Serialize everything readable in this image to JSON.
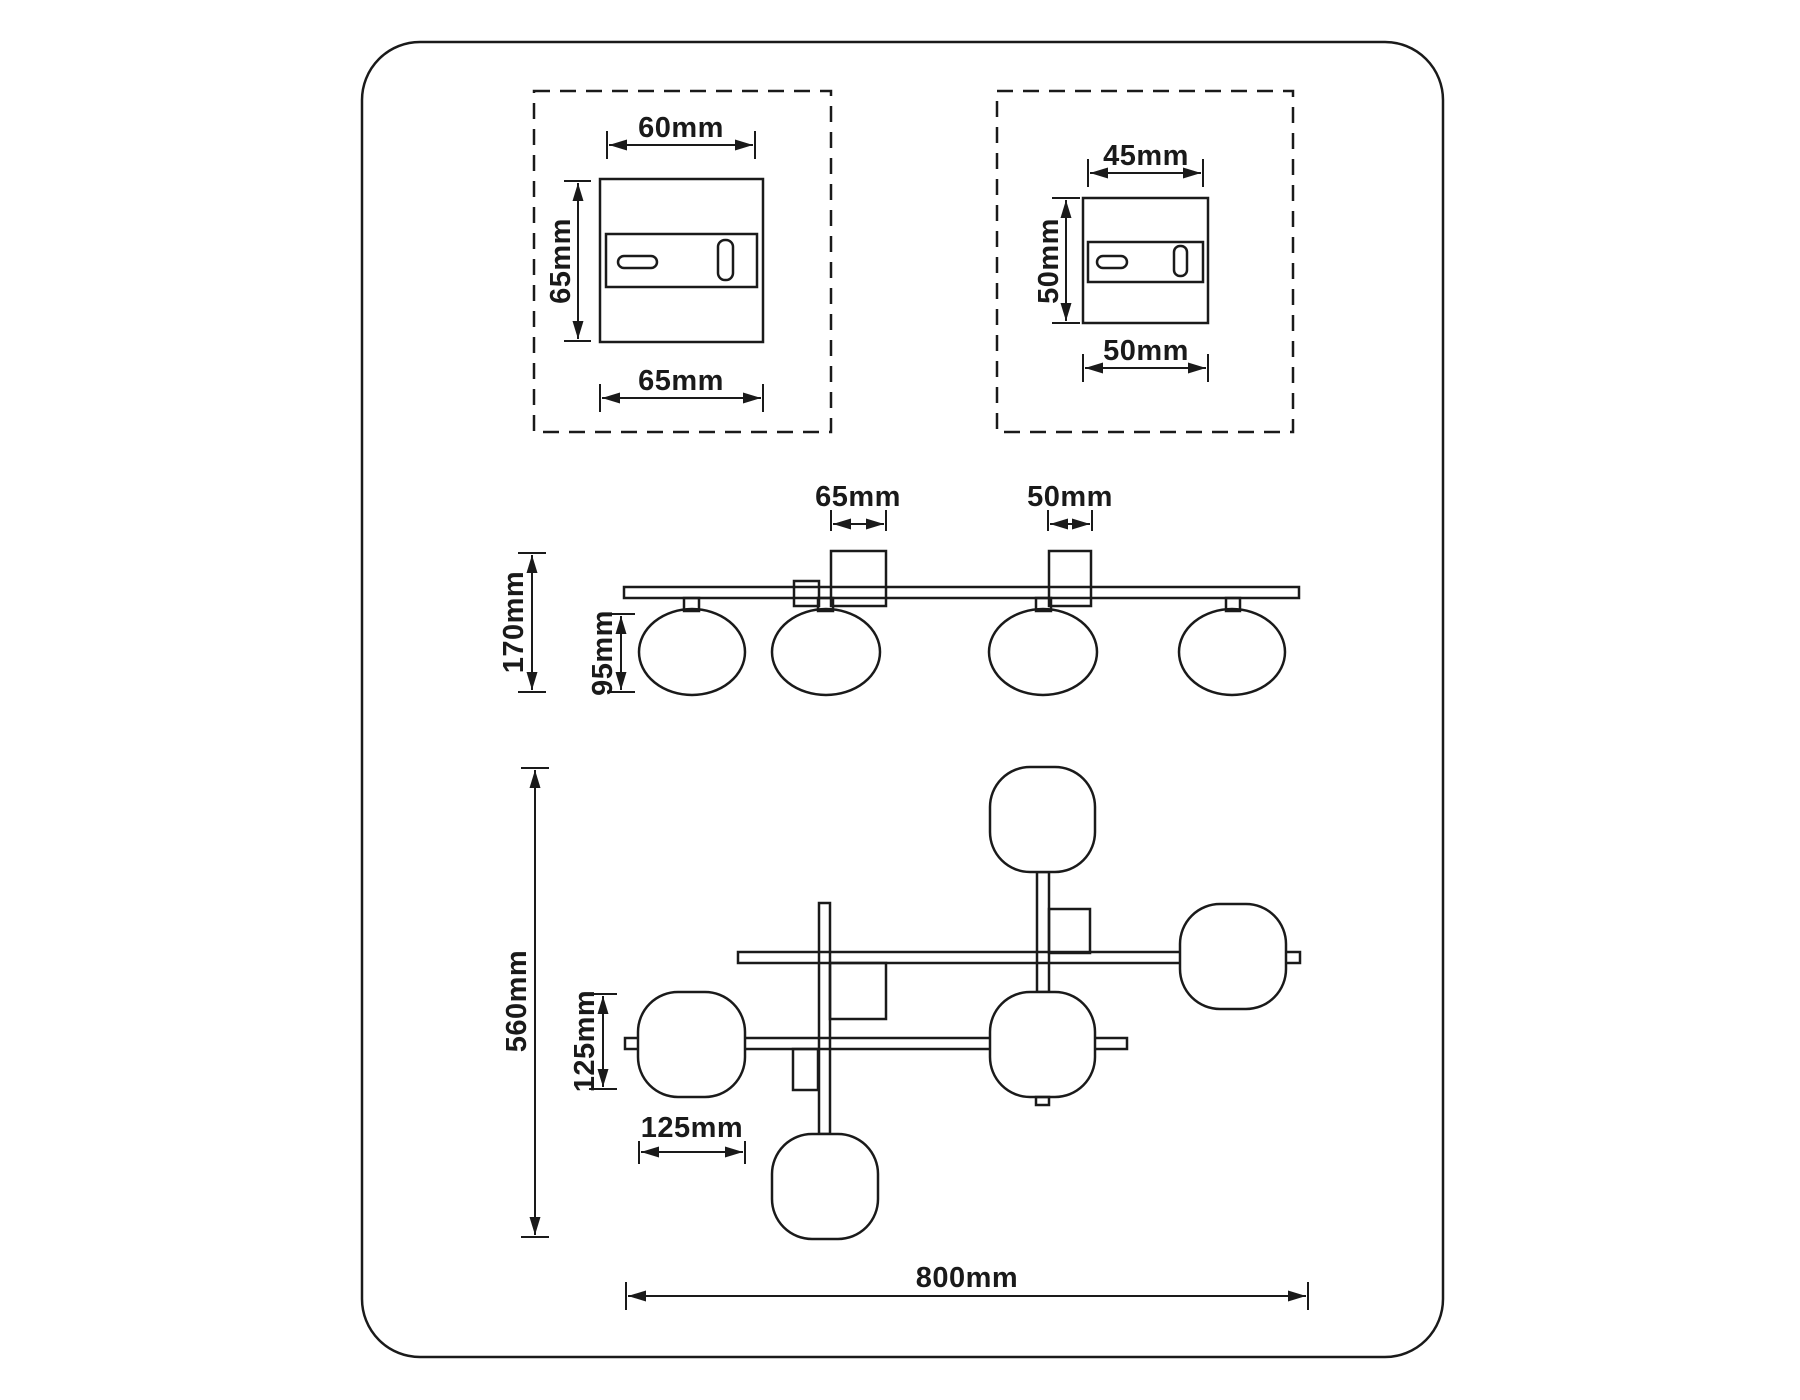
{
  "colors": {
    "line": "#1a1a1a",
    "background": "#ffffff"
  },
  "detail_large": {
    "top_width": "60mm",
    "side_height": "65mm",
    "bottom_width": "65mm"
  },
  "detail_small": {
    "top_width": "45mm",
    "side_height": "50mm",
    "bottom_width": "50mm"
  },
  "side_view": {
    "block_large_width": "65mm",
    "block_small_width": "50mm",
    "total_height": "170mm",
    "globe_height": "95mm"
  },
  "plan_view": {
    "total_height": "560mm",
    "globe_height": "125mm",
    "globe_width": "125mm",
    "total_width": "800mm"
  }
}
